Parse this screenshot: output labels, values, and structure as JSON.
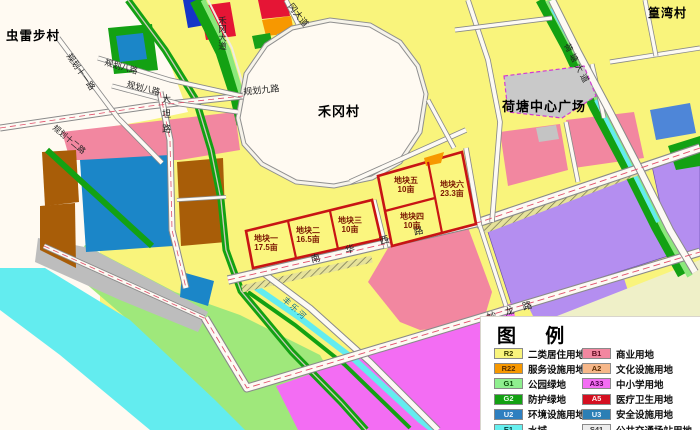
{
  "map": {
    "labels": {
      "leibu_village": "虫雷步村",
      "hegang_village": "禾冈村",
      "huangwan_village": "篁湾村",
      "hetang_plaza": "荷塘中心广场",
      "gang_avenue": "冈大道",
      "hegang_avenue": "禾冈大道",
      "hetang_avenue": "荷塘大道",
      "planned_road_9": "规划九路",
      "planned_road_11": "规划十一路",
      "planned_road_8a": "规划八路",
      "planned_road_8b": "规划八路",
      "planned_road_12": "规划十二路",
      "datan_road": "大坦路",
      "nanhuaxi_road": "南华西路",
      "miaolong_road": "妙龙路",
      "river": "丰乐河"
    },
    "plots": [
      {
        "name": "地块一",
        "area": "17.5亩"
      },
      {
        "name": "地块二",
        "area": "16.5亩"
      },
      {
        "name": "地块三",
        "area": "10亩"
      },
      {
        "name": "地块四",
        "area": "10亩"
      },
      {
        "name": "地块五",
        "area": "10亩"
      },
      {
        "name": "地块六",
        "area": "23.3亩"
      }
    ]
  },
  "legend": {
    "title": "图 例",
    "items": [
      {
        "code": "R2",
        "label": "二类居住用地",
        "color": "#f9f47c",
        "text": "#3a3a00"
      },
      {
        "code": "R22",
        "label": "服务设施用地",
        "color": "#f79800",
        "text": "#5a2d00"
      },
      {
        "code": "G1",
        "label": "公园绿地",
        "color": "#8fef8f",
        "text": "#0a4d0a"
      },
      {
        "code": "G2",
        "label": "防护绿地",
        "color": "#13a113",
        "text": "#eaffea"
      },
      {
        "code": "U2",
        "label": "环境设施用地",
        "color": "#2e7fc0",
        "text": "#eaf4ff"
      },
      {
        "code": "E1",
        "label": "水域",
        "color": "#66efef",
        "text": "#003a3a"
      },
      {
        "code": "B1",
        "label": "商业用地",
        "color": "#f287a0",
        "text": "#5c0a1e"
      },
      {
        "code": "A2",
        "label": "文化设施用地",
        "color": "#f6b789",
        "text": "#5c2d00"
      },
      {
        "code": "A33",
        "label": "中小学用地",
        "color": "#f36df3",
        "text": "#4d004d"
      },
      {
        "code": "A5",
        "label": "医疗卫生用地",
        "color": "#d40f20",
        "text": "#ffeeee"
      },
      {
        "code": "U3",
        "label": "安全设施用地",
        "color": "#2b7fb5",
        "text": "#eaf4ff"
      },
      {
        "code": "S41",
        "label": "公共交通场站用地",
        "color": "#ececec",
        "text": "#333333"
      }
    ]
  }
}
